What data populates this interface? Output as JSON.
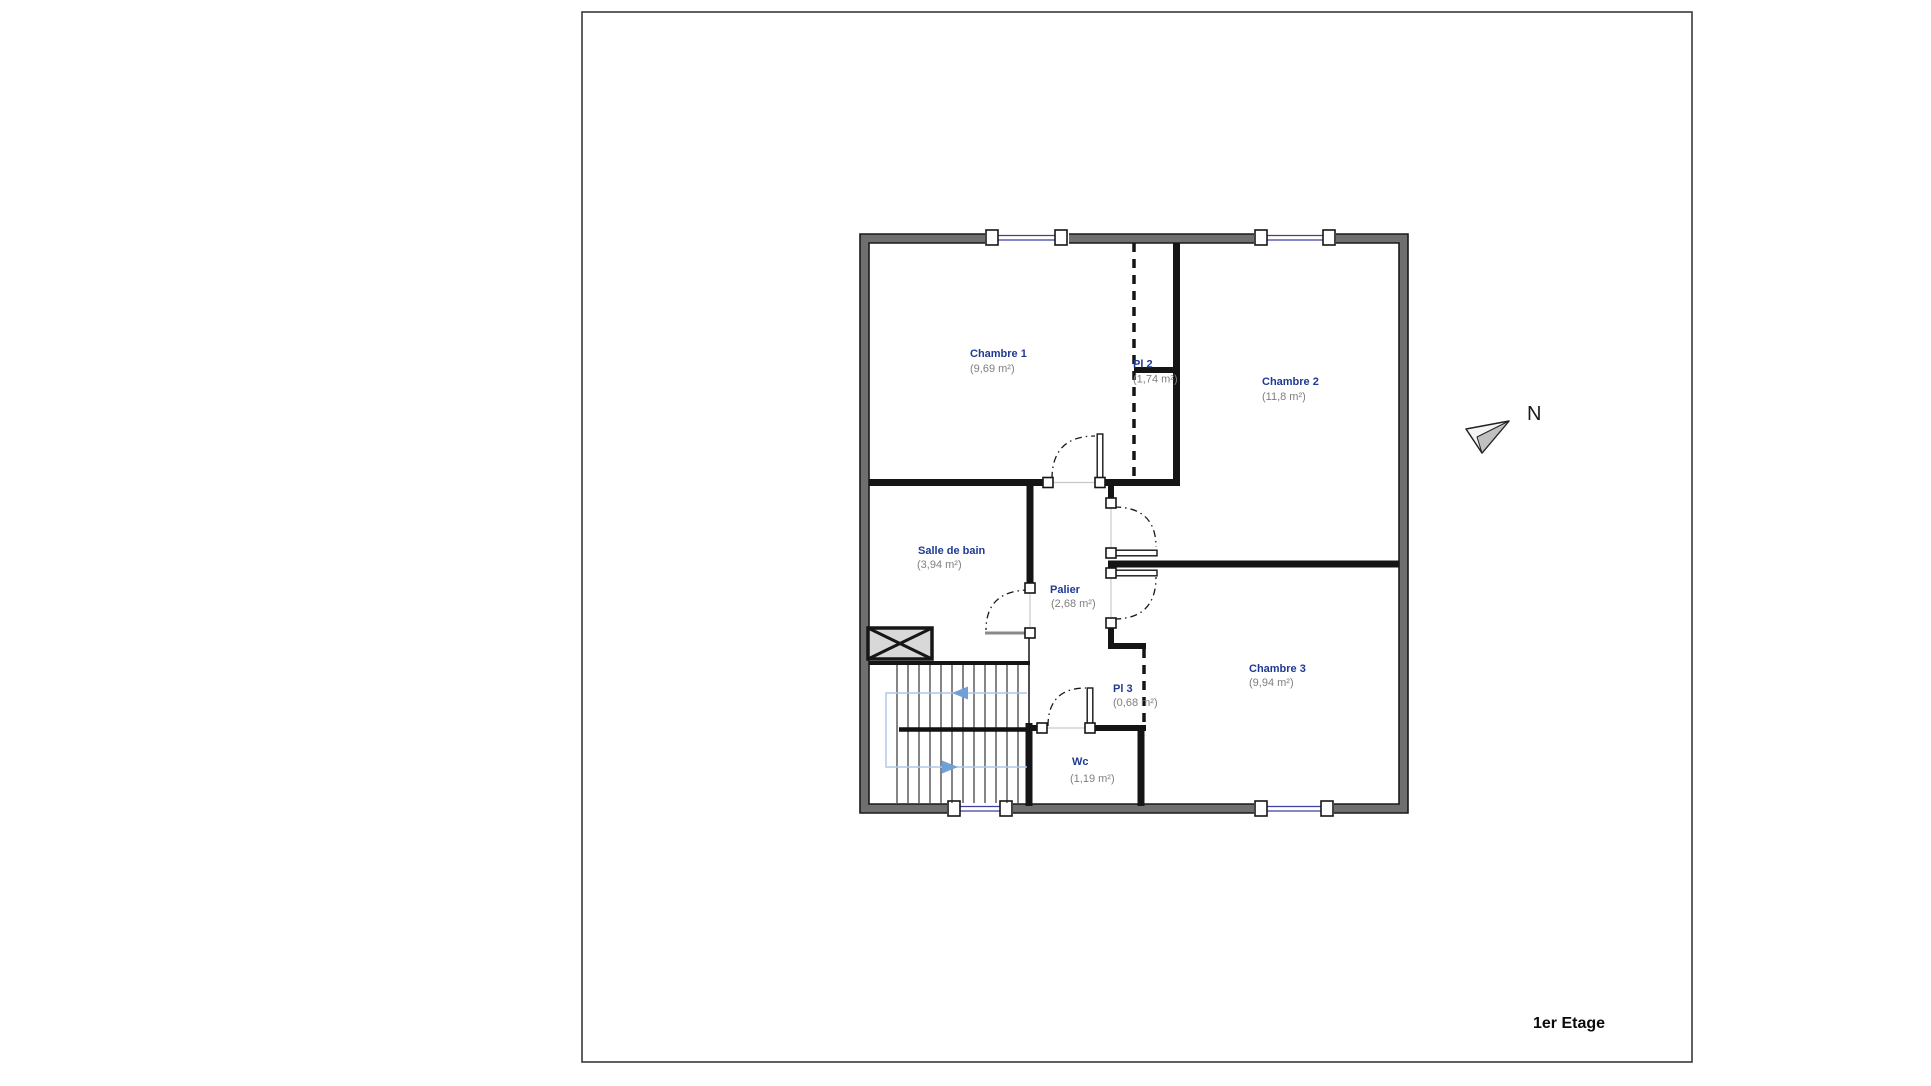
{
  "sheet": {
    "floor_title": "1er Etage",
    "north_label": "N"
  },
  "rooms": [
    {
      "id": "chambre-1",
      "name": "Chambre 1",
      "area": "(9,69 m²)"
    },
    {
      "id": "pl-2",
      "name": "Pl 2",
      "area": "(1,74 m²)"
    },
    {
      "id": "chambre-2",
      "name": "Chambre 2",
      "area": "(11,8 m²)"
    },
    {
      "id": "salle-de-bain",
      "name": "Salle de bain",
      "area": "(3,94 m²)"
    },
    {
      "id": "palier",
      "name": "Palier",
      "area": "(2,68 m²)"
    },
    {
      "id": "chambre-3",
      "name": "Chambre 3",
      "area": "(9,94 m²)"
    },
    {
      "id": "pl-3",
      "name": "Pl 3",
      "area": "(0,68 m²)"
    },
    {
      "id": "wc",
      "name": "Wc",
      "area": "(1,19 m²)"
    }
  ],
  "colors": {
    "room_label": "#1f3a93",
    "area_label": "#7f7f7f",
    "outer_wall": "#6f6f6f",
    "interior_wall": "#151515",
    "window_glazing": "#3f3f9f",
    "stair_path": "#adc9ea",
    "stair_arrow": "#6fa0d8",
    "hatch_fill": "#d8d8d8",
    "sheet_border": "#3a3a3a"
  }
}
